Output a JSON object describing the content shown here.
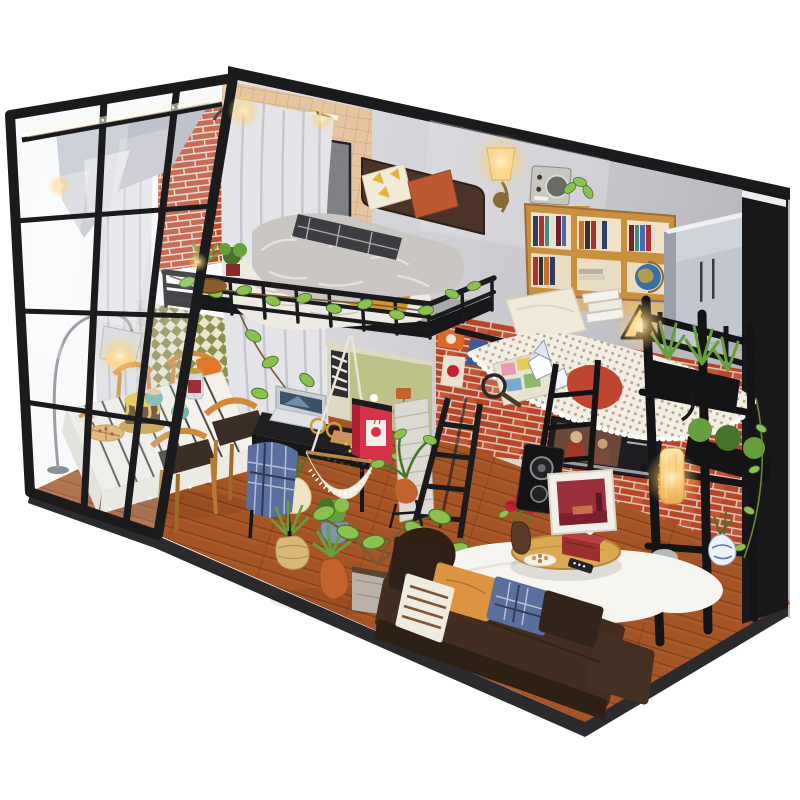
{
  "meta": {
    "type": "product-photo",
    "title": "DIY miniature dollhouse kit - loft studio apartment diorama on white background",
    "background": "#ffffff"
  },
  "palette": {
    "bg": "#ffffff",
    "frame": "#1b1b1d",
    "base": "#2b2b2e",
    "wall_light": "#d8d8dc",
    "wall_mid": "#c2c2c7",
    "wall_shadow": "#a9a9af",
    "tile": "#e6c5a0",
    "tile_line": "#c9a077",
    "brick": "#c04a2c",
    "brick_hi": "#d9704c",
    "mortar": "#ecd9c6",
    "checker_olive": "#8f8f52",
    "checker_cream": "#ece6cf",
    "door_olive": "#8f9455",
    "nook_wall": "#ddd8c2",
    "nook_olive": "#b9bd7e",
    "stone": "#d8d0ad",
    "stone_olive": "#a9a967",
    "wood": "#ae5a2a",
    "wood_dark": "#8a4018",
    "plank": "#7c3812",
    "shelf_wood": "#c8903f",
    "counter": "#d8b57c",
    "fur": "#c9c6c3",
    "fur_hi": "#e4e1de",
    "duvet": "#edeae3",
    "mustard": "#d1952c",
    "plaid": "#3d3d41",
    "headboard": "#4b3427",
    "pillow_orange": "#bf5730",
    "pillow_cream": "#f2ead8",
    "pillow_yellow": "#e5b33c",
    "leather": "#432d20",
    "leather_hi": "#5a4030",
    "leather_dark": "#2f2016",
    "crochet": "#f2eee2",
    "plant": "#66a03c",
    "plant_dark": "#47742c",
    "plant_light": "#8cc152",
    "terracotta": "#c4622e",
    "teal_pot": "#3ba7c9",
    "teal_mug": "#6fb5ad",
    "red": "#d6334a",
    "maroon": "#9c2f3c",
    "poster_dark": "#1d1d22",
    "blue_plaid": "#5a6f9e",
    "gold": "#c9993f",
    "warm": "#ffd892",
    "glow": "#ffc05e",
    "cloth": "#f3f1ea",
    "curtain": "#dddde2",
    "curtain_dark": "#b9b9c2",
    "glass": "#dfe7ec",
    "porcelain": "#eef2f6",
    "blue_detail": "#5a7ab0",
    "rug": "#f7f5f0",
    "table_wood": "#d9aa52"
  },
  "scene": {
    "poster_text": "VE",
    "areas": [
      {
        "name": "display-case",
        "label": "black wooden display case with acrylic glass wall and LED strip"
      },
      {
        "name": "bathroom",
        "label": "corner bathroom with tan tile, shower, mirror and pedestal sink"
      },
      {
        "name": "loft-bedroom",
        "label": "loft platform bedroom with fur-covered bed and ivy railing"
      },
      {
        "name": "hammock-corner",
        "label": "crochet hammock lounge against red brick wall"
      },
      {
        "name": "dining-area",
        "label": "dining table with cake and wooden chairs"
      },
      {
        "name": "study-desk",
        "label": "black desk with laptop and hanging chair"
      },
      {
        "name": "living-area",
        "label": "brown leather sofa, round coffee table and white rug"
      },
      {
        "name": "kitchen-nook",
        "label": "under-loft nook with olive door, fridge and pebble floor"
      }
    ],
    "objects": [
      {
        "name": "back-wall",
        "label": "gray concrete feature wall"
      },
      {
        "name": "brick-column",
        "label": "red brick column"
      },
      {
        "name": "shower-rod",
        "label": "curved white shower rod with sheer curtain"
      },
      {
        "name": "shower-glass",
        "label": "dark shower glass panel"
      },
      {
        "name": "pedestal-sink",
        "label": "white pedestal sink"
      },
      {
        "name": "bath-lamps",
        "label": "black gooseneck wall lamps"
      },
      {
        "name": "wall-sconce",
        "label": "lit bronze wall sconce"
      },
      {
        "name": "wall-radio",
        "label": "vintage silver radio"
      },
      {
        "name": "bookshelf",
        "label": "tan bookcase filled with colorful books"
      },
      {
        "name": "globe",
        "label": "desk globe"
      },
      {
        "name": "triangle-lamp",
        "label": "glowing triangle wire lamp"
      },
      {
        "name": "wardrobe",
        "label": "tall light-gray wardrobe cabinet"
      },
      {
        "name": "loft-bed",
        "label": "double bed with gray fur throw, plaid and mustard blankets"
      },
      {
        "name": "bed-pillows",
        "label": "cream triangle-print and rust orange pillows"
      },
      {
        "name": "loft-railing",
        "label": "black metal railing with ivy vine"
      },
      {
        "name": "hammock",
        "label": "white crochet net hammock"
      },
      {
        "name": "hammock-pillow",
        "label": "white cushion"
      },
      {
        "name": "world-map",
        "label": "folded colorful map"
      },
      {
        "name": "origami-boats",
        "label": "paper boats"
      },
      {
        "name": "red-cushion",
        "label": "rust red cushion"
      },
      {
        "name": "magnifier",
        "label": "magnifying glass"
      },
      {
        "name": "movie-poster",
        "label": "dark movie poster on brick"
      },
      {
        "name": "love-poster",
        "label": "colorful letter print"
      },
      {
        "name": "tin-signs",
        "label": "small tin sign prints"
      },
      {
        "name": "speaker",
        "label": "black loudspeaker"
      },
      {
        "name": "framed-picture",
        "label": "white framed red-room picture"
      },
      {
        "name": "dining-table",
        "label": "table with striped white cloth"
      },
      {
        "name": "chocolate-cake",
        "label": "chocolate cake with yellow icing and cherry"
      },
      {
        "name": "teal-mugs",
        "label": "two teal latte mugs"
      },
      {
        "name": "mason-jar",
        "label": "glass jar with red label"
      },
      {
        "name": "pizza-plate",
        "label": "pizza on plate"
      },
      {
        "name": "dining-chairs",
        "label": "four wooden chairs with dark seats"
      },
      {
        "name": "arc-lamp",
        "label": "lit arc floor lamp"
      },
      {
        "name": "curtains",
        "label": "sheer gray curtains and silver swag"
      },
      {
        "name": "led-strip",
        "label": "white LED bead strip on top rail"
      },
      {
        "name": "glass-wall",
        "label": "black framed acrylic window wall"
      },
      {
        "name": "desk",
        "label": "black study desk"
      },
      {
        "name": "laptop",
        "label": "open silver laptop"
      },
      {
        "name": "gold-glasses",
        "label": "gold rimmed glasses"
      },
      {
        "name": "hanging-chair",
        "label": "white crochet hanging chair"
      },
      {
        "name": "plaid-chair",
        "label": "chair draped with blue plaid blanket"
      },
      {
        "name": "coffee-cart",
        "label": "red coffee cabinet"
      },
      {
        "name": "brick-pillar",
        "label": "whitewashed brick pillar"
      },
      {
        "name": "ladder-a",
        "label": "black loft ladder"
      },
      {
        "name": "ladder-b",
        "label": "black step ladder"
      },
      {
        "name": "right-windows",
        "label": "black interior window frames"
      },
      {
        "name": "bamboo-lamp",
        "label": "warm glowing wall lantern"
      },
      {
        "name": "porcelain-vase",
        "label": "blue and white porcelain vase"
      },
      {
        "name": "planter-boxes",
        "label": "black planter boxes with green plants"
      },
      {
        "name": "sofa",
        "label": "dark brown leather sofa with throw pillows"
      },
      {
        "name": "bean-bag",
        "label": "brown bean bag"
      },
      {
        "name": "coffee-table",
        "label": "round wooden coffee table"
      },
      {
        "name": "tissue-box",
        "label": "red tissue box"
      },
      {
        "name": "rose-vase",
        "label": "vase with red roses"
      },
      {
        "name": "cookie-plate",
        "label": "plate of cookies with remote"
      },
      {
        "name": "white-rug",
        "label": "white sheepskin rug"
      },
      {
        "name": "floor-plants",
        "label": "potted plants: rope basket, orange pots, ivy cube, blue pot, gourd vase"
      }
    ]
  }
}
